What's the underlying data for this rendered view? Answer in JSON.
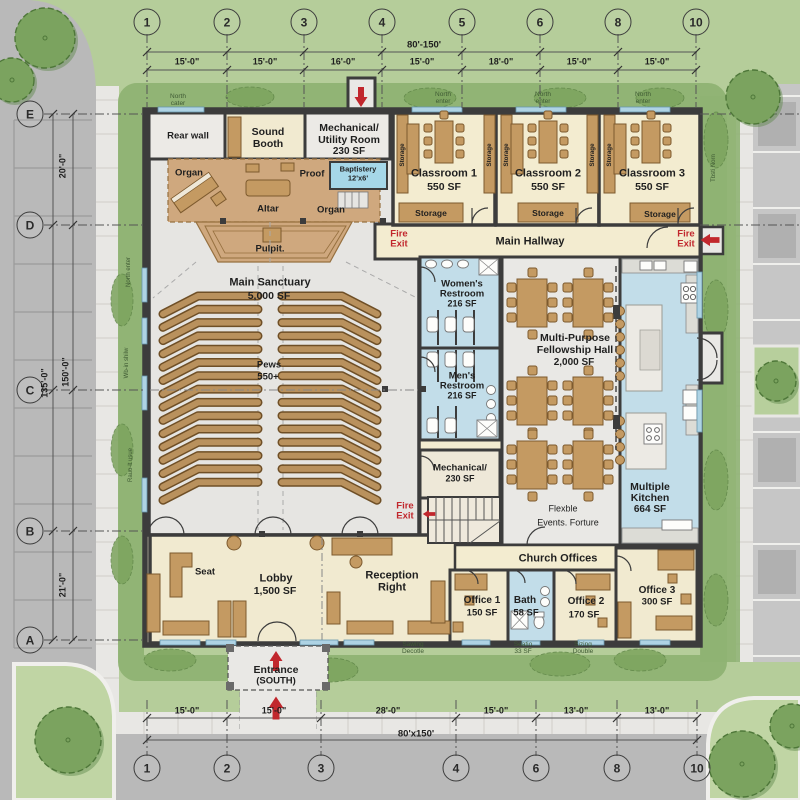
{
  "palette": {
    "grass": "#b5cd9a",
    "hedge": "#8fb273",
    "tree": "#7ba35f",
    "road": "#b9b9b9",
    "sidewalk": "#e8e7e4",
    "wall": "#3c3c3c",
    "floor_cream": "#f3ecd0",
    "floor_gray": "#e6e5e2",
    "room_blue": "#c2dde9",
    "stage_tan": "#cfa87e",
    "furniture_tan": "#c49a62",
    "accent_red": "#c1272d"
  },
  "grid": {
    "top_columns": [
      "1",
      "2",
      "3",
      "4",
      "5",
      "6",
      "8",
      "10"
    ],
    "bottom_columns": [
      "1",
      "2",
      "3",
      "4",
      "6",
      "8",
      "10"
    ],
    "rows": [
      "E",
      "D",
      "C",
      "B",
      "A"
    ],
    "top_dims": [
      "15'-0\"",
      "15'-0\"",
      "16'-0\"",
      "15'-0\"",
      "18'-0\"",
      "15'-0\"",
      "15'-0\""
    ],
    "top_overall": "80'-150'",
    "bottom_dims": [
      "15'-0\"",
      "15'-0\"",
      "28'-0\"",
      "15'-0\"",
      "13'-0\"",
      "13'-0\""
    ],
    "bottom_overall": "80'x150'",
    "left_dims": [
      "20'-0\"",
      "150'-0\"",
      "135'-0\"",
      "21'-0\""
    ]
  },
  "rooms": {
    "rear_wall": "Rear wall",
    "sound_booth": {
      "l1": "Sound",
      "l2": "Booth"
    },
    "mech_utility": {
      "l1": "Mechanical/",
      "l2": "Utility Room",
      "sf": "230 SF"
    },
    "classroom1": {
      "name": "Classroom 1",
      "sf": "550 SF"
    },
    "classroom2": {
      "name": "Classroom 2",
      "sf": "550 SF"
    },
    "classroom3": {
      "name": "Classroom 3",
      "sf": "550 SF"
    },
    "storage": "Storage",
    "main_hallway": "Main Hallway",
    "fire_exit": {
      "l1": "Fire",
      "l2": "Exit"
    },
    "stage": {
      "organ_left": "Organ",
      "proof": "Proof",
      "baptistery_l1": "Baptistery",
      "baptistery_l2": "12'x6'",
      "altar": "Altar",
      "organ_right": "Organ",
      "pulpit": "Pulpit."
    },
    "sanctuary": {
      "name": "Main Sanctuary",
      "sf": "5,000 SF",
      "pews_l1": "Pews",
      "pews_l2": "550+"
    },
    "womens": {
      "l1": "Women's",
      "l2": "Restroom",
      "sf": "216 SF"
    },
    "mens": {
      "l1": "Men's",
      "l2": "Restroom",
      "sf": "216 SF"
    },
    "mechanical2": {
      "l1": "Mechanical/",
      "sf": "230 SF"
    },
    "fellowship": {
      "l1": "Multi-Purpose",
      "l2": "Fellowship Hall",
      "sf": "2,000 SF",
      "note1": "Flexble",
      "note2": "Events. Forture"
    },
    "kitchen": {
      "l1": "Multiple",
      "l2": "Kitchen",
      "sf": "664 SF"
    },
    "lobby": {
      "name": "Lobby",
      "sf": "1,500 SF",
      "seat": "Seat"
    },
    "reception": {
      "l1": "Reception",
      "l2": "Right"
    },
    "church_offices": "Church Offices",
    "office1": {
      "name": "Office 1",
      "sf": "150 SF"
    },
    "bath": {
      "name": "Bath",
      "sf": "58 SF"
    },
    "office2": {
      "name": "Office 2",
      "sf": "170 SF"
    },
    "office3": {
      "name": "Office 3",
      "sf": "300 SF"
    },
    "entrance": {
      "l1": "Entrance",
      "l2": "(SOUTH)"
    }
  },
  "site": {
    "north_labels": [
      {
        "l1": "North",
        "l2": "cater"
      },
      {
        "l1": "North",
        "l2": "enter"
      },
      {
        "l1": "North",
        "l2": "enter"
      },
      {
        "l1": "North",
        "l2": "enter"
      }
    ],
    "edge_labels": [
      "North enter",
      "Wb-in shilw",
      "Rauo-lt usue",
      "Tbsti Norn"
    ],
    "small_notes": [
      {
        "l1": "Sawing",
        "l2": "Decotle"
      },
      {
        "l1": "Seatio",
        "l2": "33 SF"
      },
      {
        "l1": "Sizing",
        "l2": "Double"
      }
    ]
  }
}
